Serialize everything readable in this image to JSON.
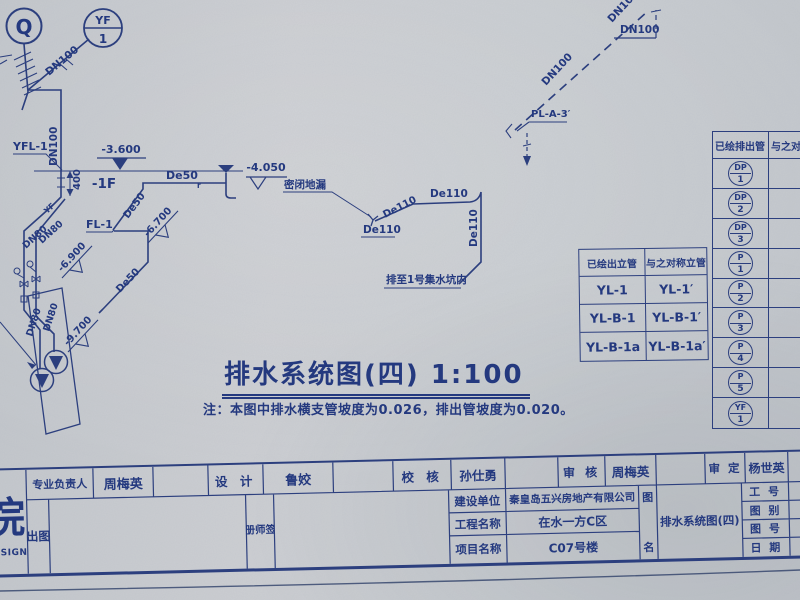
{
  "drawing": {
    "title": "排水系统图(四) 1:100",
    "note": "注：本图中排水横支管坡度为0.026，排出管坡度为0.020。",
    "ink_color": "#2c3f7e",
    "paper_color": "#c8ccd1",
    "labels": {
      "q": "Q",
      "yf_top": "YF",
      "yf_num": "1",
      "dn100_riser": "DN100",
      "dn100_vertical": "DN100",
      "yfl1": "YFL-1",
      "elev_3600": "-3.600",
      "floor_1f": "-1F",
      "dim_400": "400",
      "de50_h": "De50",
      "de50_h_sub": "r",
      "elev_4050": "-4.050",
      "fl1": "FL-1",
      "de50_branch": "De50",
      "elev_6700": "-6.700",
      "elev_6900": "-6.900",
      "de50_long": "De50",
      "elev_9700": "-9.700",
      "dn80_1": "DN80",
      "dn80_2": "DN80",
      "dn80_3": "DN80",
      "dn80_4": "DN80",
      "yf_pipe": "YF",
      "floor_drain": "密闭地漏",
      "de110_drain": "De110",
      "de110_diag": "De110",
      "de110_h": "De110",
      "de110_v": "De110",
      "sump_note": "排至1号集水坑内",
      "dn100_dash_upper": "DN100",
      "dn100_dash_lower": "DN100",
      "dn100_dash_h": "DN100",
      "pl_a3": "PL-A-3′"
    }
  },
  "riser_table": {
    "header_left": "已绘出立管",
    "header_right": "与之对称立管",
    "rows": [
      {
        "left": "YL-1",
        "right": "YL-1′"
      },
      {
        "left": "YL-B-1",
        "right": "YL-B-1′"
      },
      {
        "left": "YL-B-1a",
        "right": "YL-B-1a′"
      }
    ]
  },
  "outlet_table": {
    "header_left": "已绘排出管",
    "header_right": "与之对",
    "rows": [
      {
        "l_top": "DP",
        "l_num": "1",
        "r_top": "",
        "r_num": ""
      },
      {
        "l_top": "DP",
        "l_num": "2",
        "r_top": "DP",
        "r_num": "2′"
      },
      {
        "l_top": "DP",
        "l_num": "3",
        "r_top": "DP",
        "r_num": "3′"
      },
      {
        "l_top": "P",
        "l_num": "1",
        "r_top": "",
        "r_num": ""
      },
      {
        "l_top": "P",
        "l_num": "2",
        "r_top": "P",
        "r_num": "2′"
      },
      {
        "l_top": "P",
        "l_num": "3",
        "r_top": "P",
        "r_num": "3′"
      },
      {
        "l_top": "P",
        "l_num": "4",
        "r_top": "P",
        "r_num": "4′"
      },
      {
        "l_top": "P",
        "l_num": "5",
        "r_top": "",
        "r_num": ""
      },
      {
        "l_top": "YF",
        "l_num": "1",
        "r_top": "YF",
        "r_num": "1′"
      }
    ]
  },
  "titleblock": {
    "logo_char": "院",
    "logo_sub": "DESIGN",
    "row1": [
      {
        "label": "专业负责人",
        "value": "周梅英"
      },
      {
        "label": "设 计",
        "value": "鲁姣"
      },
      {
        "label": "校 核",
        "value": "孙仕勇"
      },
      {
        "label": "审 核",
        "value": "周梅英"
      },
      {
        "label": "审 定",
        "value": "杨世英"
      }
    ],
    "plot_label": "出图",
    "seal_label": "注册师签章",
    "project_rows": [
      {
        "label": "建设单位",
        "value": "秦皇岛五兴房地产有限公司"
      },
      {
        "label": "工程名称",
        "value": "在水一方C区"
      },
      {
        "label": "项目名称",
        "value": "C07号楼"
      }
    ],
    "fig_label_top": "图",
    "fig_label_bottom": "名",
    "drawing_name": "排水系统图(四)",
    "right_rows": [
      {
        "label": "工 号"
      },
      {
        "label": "图 别"
      },
      {
        "label": "图 号"
      },
      {
        "label": "日 期"
      }
    ]
  }
}
